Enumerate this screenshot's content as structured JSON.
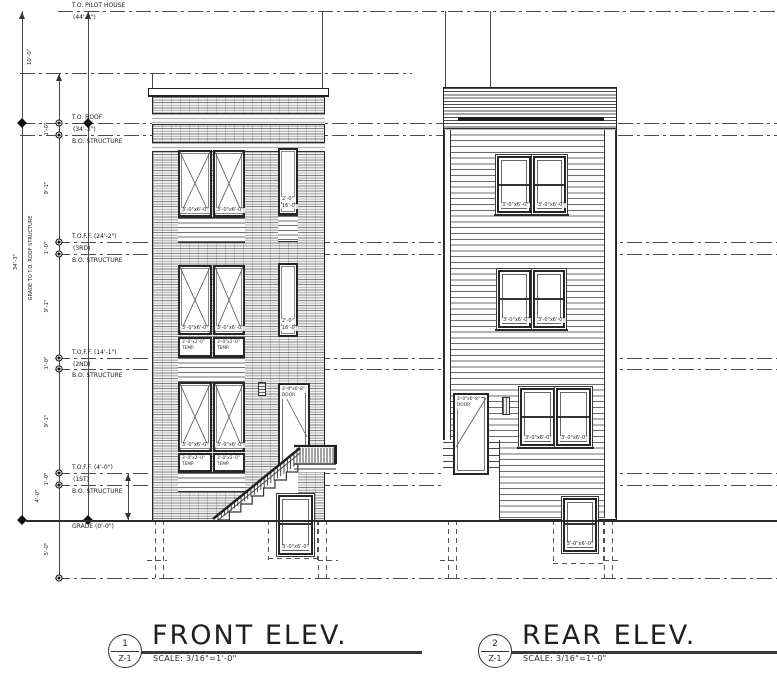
{
  "sheet": {
    "front_title": {
      "number": "1",
      "sheet": "Z-1",
      "title": "FRONT ELEV.",
      "scale": "SCALE: 3/16\"=1'-0\""
    },
    "rear_title": {
      "number": "2",
      "sheet": "Z-1",
      "title": "REAR ELEV.",
      "scale": "SCALE: 3/16\"=1'-0\""
    }
  },
  "levels": [
    {
      "name": "T.O. PILOT HOUSE",
      "elev": "(44'-3\")"
    },
    {
      "name": "",
      "elev": ""
    },
    {
      "name": "T.O. ROOF",
      "elev": "(34'-3\")"
    },
    {
      "name": "B.O. STRUCTURE",
      "elev": ""
    },
    {
      "name": "T.O.F.F. (24'-2\")",
      "elev": "(3RD)"
    },
    {
      "name": "B.O. STRUCTURE",
      "elev": ""
    },
    {
      "name": "T.O.F.F. (14'-1\")",
      "elev": "(2ND)"
    },
    {
      "name": "B.O. STRUCTURE",
      "elev": ""
    },
    {
      "name": "T.O.F.F. (4'-0\")",
      "elev": "(1ST)"
    },
    {
      "name": "B.O. STRUCTURE",
      "elev": ""
    },
    {
      "name": "GRADE (0'-0\")",
      "elev": ""
    },
    {
      "name": "",
      "elev": ""
    }
  ],
  "dimensions": {
    "pilot_height": "10'-0\"",
    "overall": "34'-3\"",
    "overall_note": "GRADE TO T.O. ROOF STRUCTURE",
    "floor_floor": "9'-1\"",
    "structure": "1'-0\"",
    "first_floor": "4'-0\"",
    "below_grade": "5'-0\""
  },
  "front": {
    "window": "3'-0\"x6'-0\"",
    "temp1": "3'-0\"x2'-0\"",
    "temp2": "TEMP.",
    "tall1": "2'-0\"",
    "tall2": "16'-0\"",
    "door1": "3'-0\"x6'-8\"",
    "door2": "DOOR",
    "basement": "3'-0\"x6'-0\""
  },
  "rear": {
    "window": "3'-0\"x6'-0\"",
    "door1": "3'-0\"x6'-8\"",
    "door2": "DOOR",
    "basement": "3'-0\"x6'-0\""
  }
}
